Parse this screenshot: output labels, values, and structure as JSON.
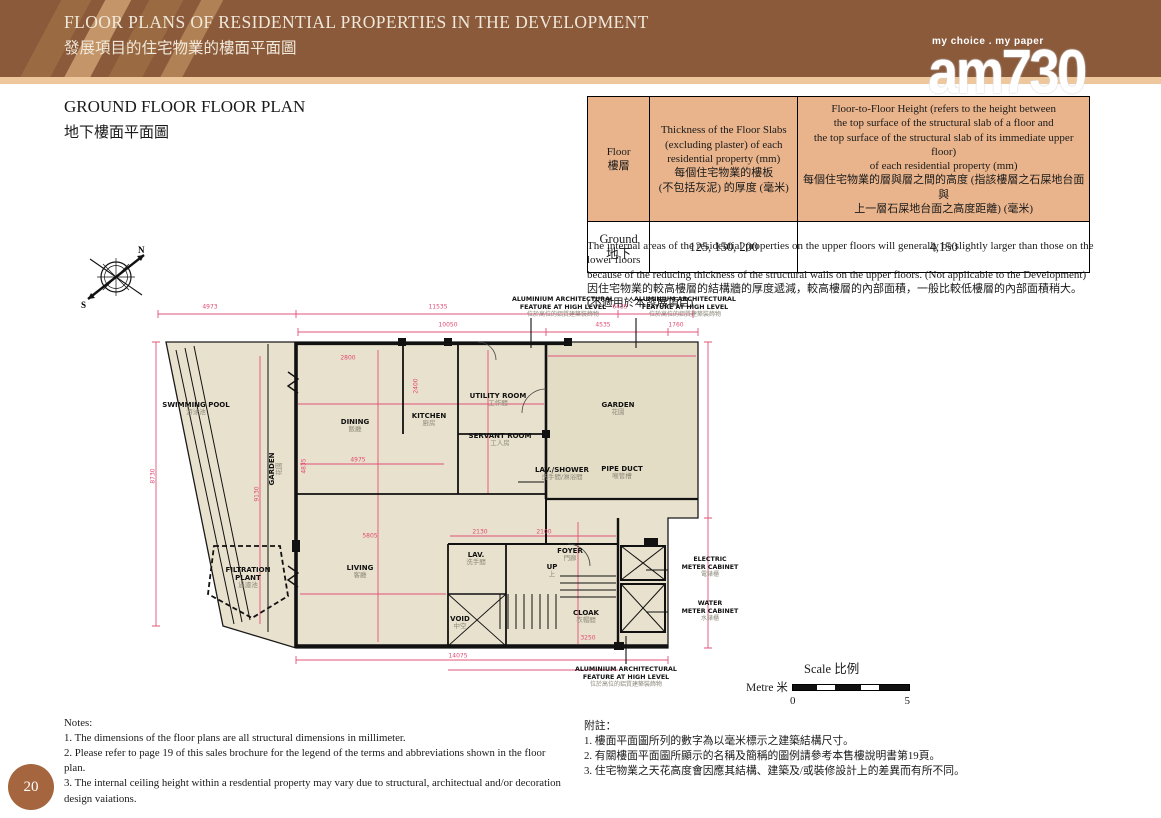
{
  "colors": {
    "header_brown": "#8a5a3b",
    "header_stripe_dark": "#9a6a42",
    "header_stripe_light": "#c39568",
    "accent_strip": "#eec79c",
    "table_header_bg": "#e9b48c",
    "plan_fill": "#e8e1cd",
    "dimension_pink": "#e24a72",
    "page_circle": "#a4653f"
  },
  "header": {
    "title_en": "FLOOR PLANS OF RESIDENTIAL PROPERTIES IN THE DEVELOPMENT",
    "title_zh": "發展項目的住宅物業的樓面平面圖"
  },
  "logo": {
    "tagline": "my choice . my paper",
    "brand": "am730"
  },
  "section_title": {
    "en": "GROUND FLOOR FLOOR PLAN",
    "zh": "地下樓面平面圖"
  },
  "table": {
    "col_floor": "Floor\n樓層",
    "col_thickness": "Thickness of the Floor Slabs\n(excluding plaster) of each\nresidential property (mm)\n每個住宅物業的樓板\n(不包括灰泥) 的厚度 (毫米)",
    "col_height": "Floor-to-Floor Height (refers to the height between\nthe top surface of the structural slab of a floor and\nthe top surface of the structural slab of its immediate upper floor)\nof each residential property (mm)\n每個住宅物業的層與層之間的高度 (指該樓層之石屎地台面與\n上一層石屎地台面之高度距離) (毫米)",
    "row": {
      "floor": "Ground\n地下",
      "thickness": "125, 150, 200",
      "height": "4,150"
    }
  },
  "disclaimer": {
    "en": "The internal areas of the residential properties on the upper floors will generally be slightly larger than those on the lower floors\nbecause of the reducing thickness of the structural walls on the upper floors. (Not applicable to the Development)",
    "zh": "因住宅物業的較高樓層的結構牆的厚度遞減，較高樓層的內部面積，一般比較低樓層的內部面積稍大。\n(不適用於本發展項目)"
  },
  "compass": {
    "north": "N",
    "south": "S"
  },
  "plan": {
    "rooms": [
      {
        "en": "SWIMMING POOL",
        "zh": "游泳池",
        "x": 48,
        "y": 115
      },
      {
        "en": "GARDEN",
        "zh": "花園",
        "x": 128,
        "y": 175,
        "v": true
      },
      {
        "en": "DINING",
        "zh": "飯廳",
        "x": 207,
        "y": 132
      },
      {
        "en": "KITCHEN",
        "zh": "廚房",
        "x": 281,
        "y": 126
      },
      {
        "en": "UTILITY ROOM",
        "zh": "工作間",
        "x": 350,
        "y": 106
      },
      {
        "en": "SERVANT ROOM",
        "zh": "工人房",
        "x": 352,
        "y": 146
      },
      {
        "en": "GARDEN",
        "zh": "花園",
        "x": 470,
        "y": 115
      },
      {
        "en": "LAV./SHOWER",
        "zh": "洗手間/淋浴間",
        "x": 414,
        "y": 180
      },
      {
        "en": "PIPE DUCT",
        "zh": "喉管槽",
        "x": 474,
        "y": 179
      },
      {
        "en": "FOYER",
        "zh": "門廊",
        "x": 422,
        "y": 261
      },
      {
        "en": "UP",
        "zh": "上",
        "x": 404,
        "y": 277
      },
      {
        "en": "LIVING",
        "zh": "客廳",
        "x": 212,
        "y": 278
      },
      {
        "en": "LAV.",
        "zh": "洗手間",
        "x": 328,
        "y": 265
      },
      {
        "en": "VOID",
        "zh": "中空",
        "x": 312,
        "y": 329
      },
      {
        "en": "CLOAK",
        "zh": "衣帽間",
        "x": 438,
        "y": 323
      },
      {
        "en": "FILTRATION\nPLANT",
        "zh": "過濾池",
        "x": 100,
        "y": 284
      }
    ],
    "dims": [
      {
        "t": "4973",
        "x": 62,
        "y": 13
      },
      {
        "t": "11535",
        "x": 290,
        "y": 13
      },
      {
        "t": "6435",
        "x": 472,
        "y": 13
      },
      {
        "t": "10050",
        "x": 300,
        "y": 31
      },
      {
        "t": "4535",
        "x": 455,
        "y": 31
      },
      {
        "t": "1760",
        "x": 528,
        "y": 31
      },
      {
        "t": "8730",
        "x": 5,
        "y": 182,
        "r": -90
      },
      {
        "t": "9130",
        "x": 109,
        "y": 200,
        "r": -90
      },
      {
        "t": "2800",
        "x": 200,
        "y": 64
      },
      {
        "t": "4835",
        "x": 156,
        "y": 172,
        "r": -90
      },
      {
        "t": "4975",
        "x": 210,
        "y": 166
      },
      {
        "t": "2400",
        "x": 268,
        "y": 92,
        "r": -90
      },
      {
        "t": "2130",
        "x": 332,
        "y": 238
      },
      {
        "t": "2100",
        "x": 396,
        "y": 238
      },
      {
        "t": "5805",
        "x": 222,
        "y": 242
      },
      {
        "t": "3250",
        "x": 440,
        "y": 344
      },
      {
        "t": "14075",
        "x": 310,
        "y": 362
      }
    ],
    "alum_feature": {
      "en": "ALUMINIUM ARCHITECTURAL FEATURE AT HIGH LEVEL",
      "zh": "位於高位的鋁質建築裝飾物"
    },
    "electric_meter": {
      "en": "ELECTRIC\nMETER CABINET",
      "zh": "電錶櫃"
    },
    "water_meter": {
      "en": "WATER\nMETER CABINET",
      "zh": "水錶櫃"
    }
  },
  "scale": {
    "title": "Scale 比例",
    "unit": "Metre 米",
    "start": "0",
    "end": "5"
  },
  "notes_en": {
    "heading": "Notes:",
    "items": [
      "1. The dimensions of the floor plans are all structural dimensions in millimeter.",
      "2. Please refer to page 19 of this sales brochure for the legend of the terms and abbreviations shown in the floor plan.",
      "3. The internal ceiling height within a resdential property may vary due to structural, architectual and/or decoration design vaiations."
    ]
  },
  "notes_zh": {
    "heading": "附註：",
    "items": [
      "1. 樓面平面圖所列的數字為以毫米標示之建築結構尺寸。",
      "2. 有關樓面平面圖所顯示的名稱及簡稱的圖例請參考本售樓說明書第19頁。",
      "3. 住宅物業之天花高度會因應其結構、建築及/或裝修設計上的差異而有所不同。"
    ]
  },
  "page_number": "20"
}
